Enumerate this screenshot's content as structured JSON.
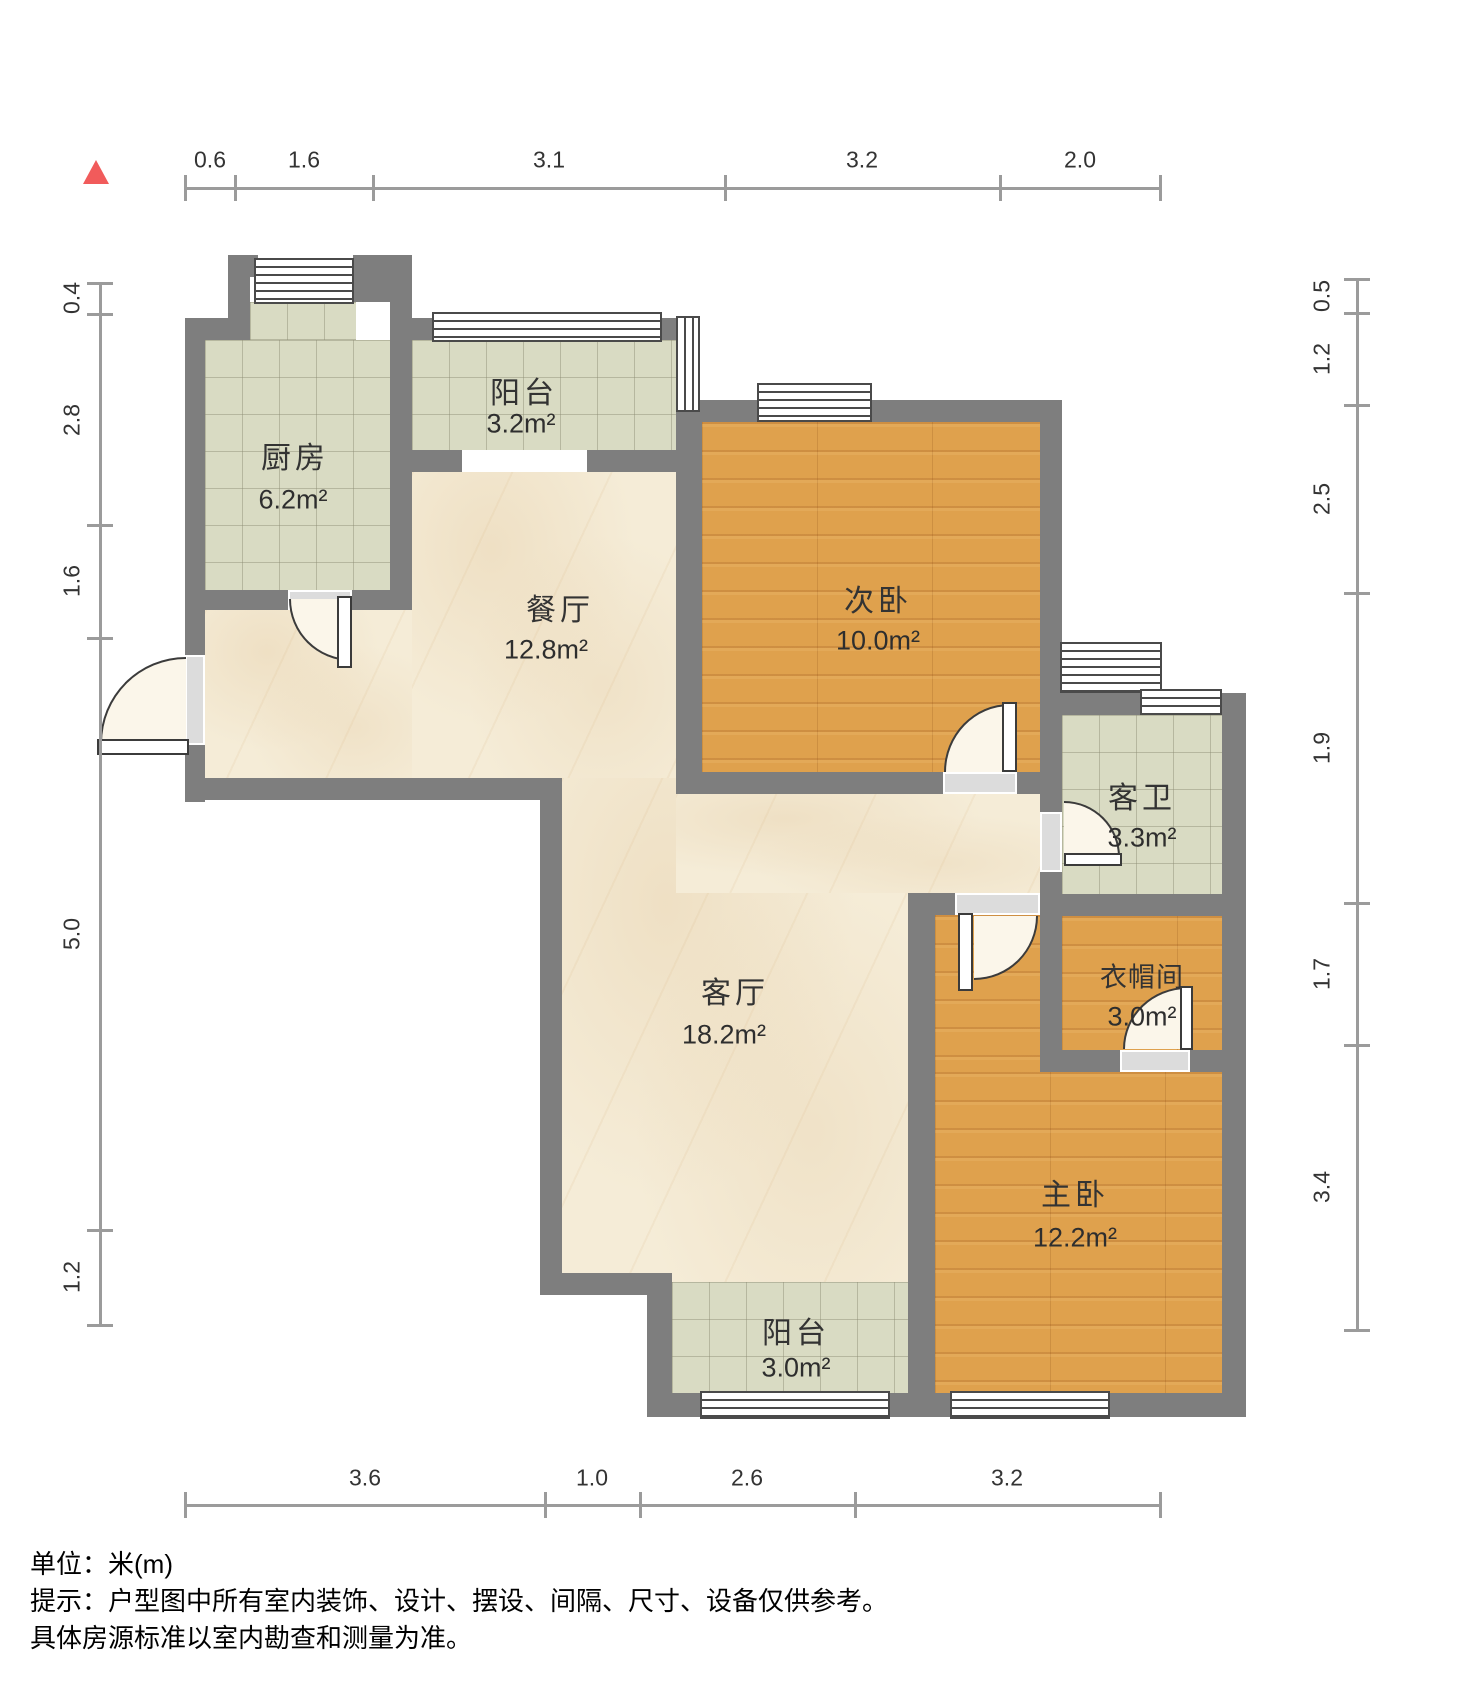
{
  "compass": {
    "direction": "north",
    "color": "#f15b5b"
  },
  "rooms": [
    {
      "name": "厨房",
      "area": "6.2m²"
    },
    {
      "name": "阳台",
      "area": "3.2m²"
    },
    {
      "name": "餐厅",
      "area": "12.8m²"
    },
    {
      "name": "次卧",
      "area": "10.0m²"
    },
    {
      "name": "客卫",
      "area": "3.3m²"
    },
    {
      "name": "衣帽间",
      "area": "3.0m²"
    },
    {
      "name": "客厅",
      "area": "18.2m²"
    },
    {
      "name": "主卧",
      "area": "12.2m²"
    },
    {
      "name": "阳台",
      "area": "3.0m²"
    }
  ],
  "dimensions": {
    "top": [
      "0.6",
      "1.6",
      "3.1",
      "3.2",
      "2.0"
    ],
    "left": [
      "0.4",
      "2.8",
      "1.6",
      "5.0",
      "1.2"
    ],
    "right": [
      "0.5",
      "1.2",
      "2.5",
      "1.9",
      "1.7",
      "3.4"
    ],
    "bottom": [
      "3.6",
      "1.0",
      "2.6",
      "3.2"
    ]
  },
  "footer": {
    "unit": "单位：米(m)",
    "note1": "提示：户型图中所有室内装饰、设计、摆设、间隔、尺寸、设备仅供参考。",
    "note2": "具体房源标准以室内勘查和测量为准。"
  },
  "colors": {
    "wall": "#7e7e7e",
    "wood": "#dfa14d",
    "tile": "#d9dbc3",
    "marble": "#f5ecd7"
  }
}
